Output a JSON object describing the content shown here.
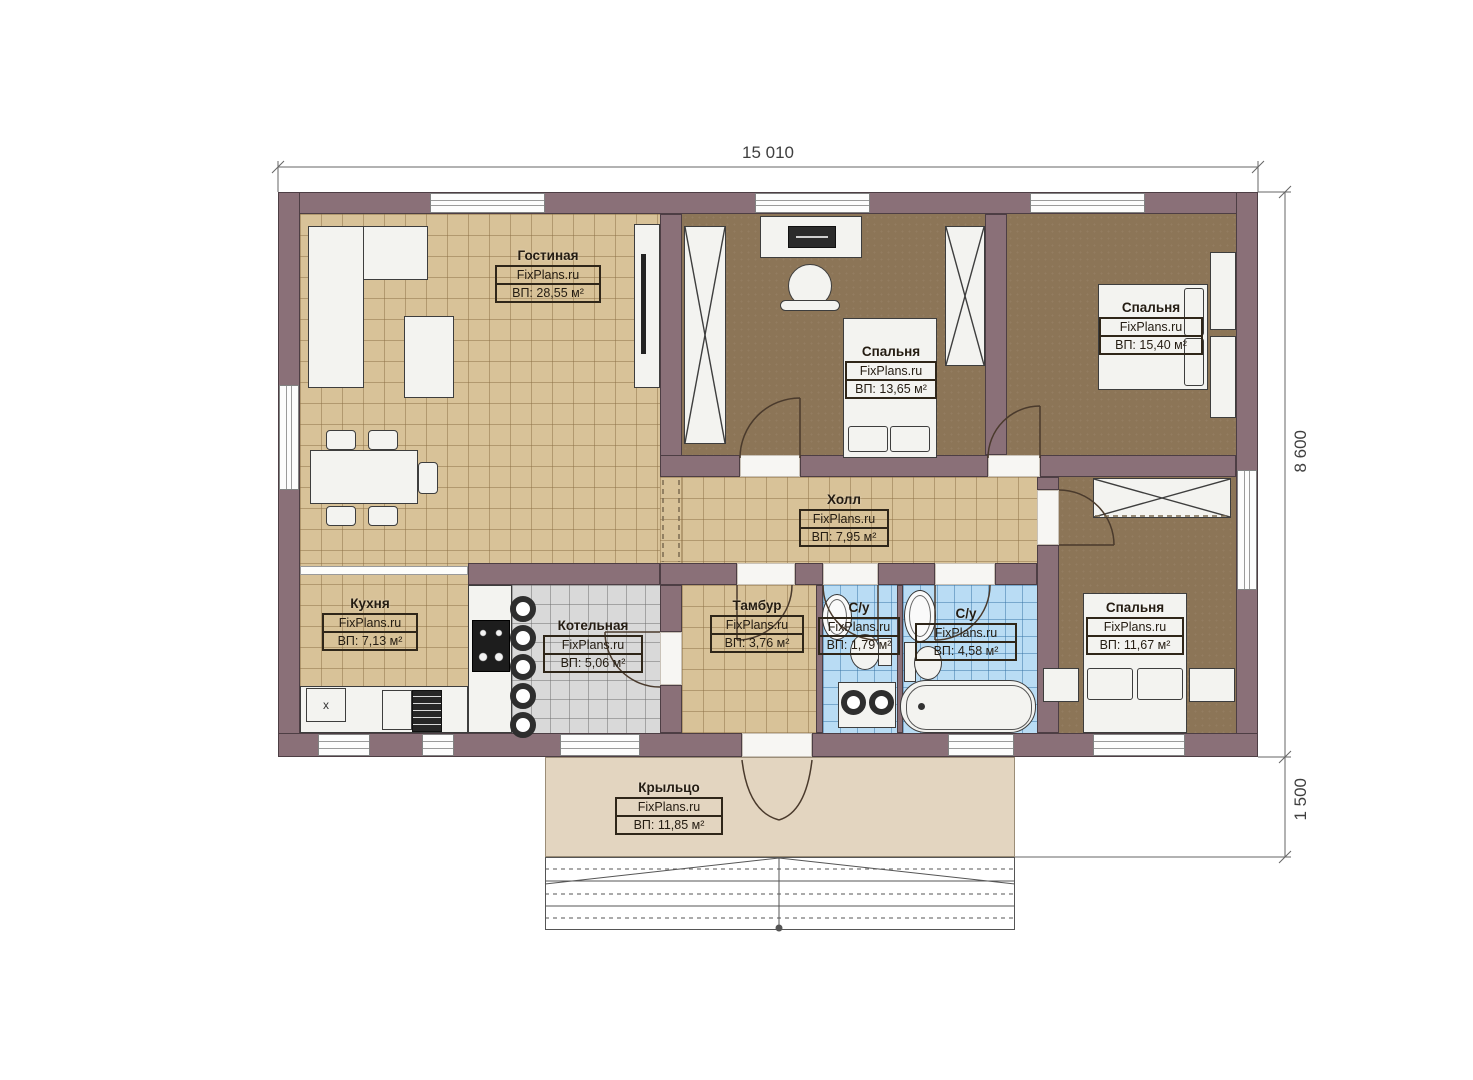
{
  "watermark": "FixPlans.ru",
  "dimensions": {
    "width": "15 010",
    "height": "8 600",
    "porch_depth": "1 500"
  },
  "rooms": {
    "living": {
      "name": "Гостиная",
      "area": "ВП: 28,55 м²"
    },
    "bedroom1": {
      "name": "Спальня",
      "area": "ВП: 13,65 м²"
    },
    "bedroom2": {
      "name": "Спальня",
      "area": "ВП: 15,40 м²"
    },
    "hall": {
      "name": "Холл",
      "area": "ВП: 7,95 м²"
    },
    "kitchen": {
      "name": "Кухня",
      "area": "ВП: 7,13 м²"
    },
    "boiler": {
      "name": "Котельная",
      "area": "ВП: 5,06 м²"
    },
    "vestibule": {
      "name": "Тамбур",
      "area": "ВП: 3,76 м²"
    },
    "wc_small": {
      "name": "С/у",
      "area": "ВП: 1,79 м²"
    },
    "wc_large": {
      "name": "С/у",
      "area": "ВП: 4,58 м²"
    },
    "bedroom3": {
      "name": "Спальня",
      "area": "ВП: 11,67 м²"
    },
    "porch": {
      "name": "Крыльцо",
      "area": "ВП: 11,85 м²"
    }
  },
  "kitchen_marker": "x",
  "colors": {
    "wall": "#8a7078",
    "floorLiving": "#d8c298",
    "floorBedroom": "#8c7557",
    "floorBoiler": "#d9d9d9",
    "floorBath": "#b9dcf4",
    "floorPorch": "#e3d5c0"
  }
}
